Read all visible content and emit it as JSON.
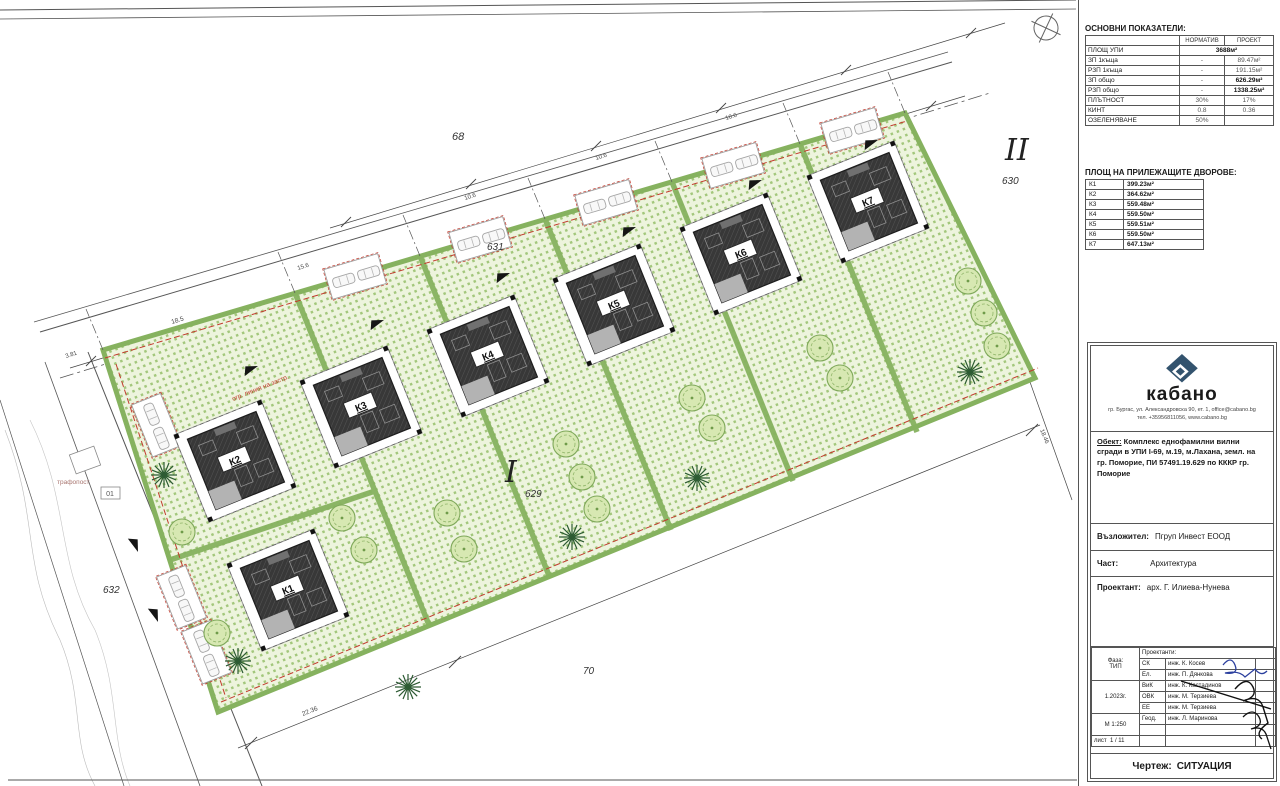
{
  "indicators_table": {
    "title": "ОСНОВНИ ПОКАЗАТЕЛИ:",
    "col_headers": [
      "НОРМАТИВ",
      "ПРОЕКТ"
    ],
    "rows": [
      {
        "label": "ПЛОЩ УПИ",
        "norm": "3688м²",
        "proj": ""
      },
      {
        "label": "ЗП 1къща",
        "norm": "-",
        "proj": "89.47м²"
      },
      {
        "label": "РЗП 1къща",
        "norm": "-",
        "proj": "191.15м²"
      },
      {
        "label": "ЗП общо",
        "norm": "-",
        "proj": "626.29м²"
      },
      {
        "label": "РЗП общо",
        "norm": "-",
        "proj": "1338.25м²"
      },
      {
        "label": "ПЛЪТНОСТ",
        "norm": "30%",
        "proj": "17%"
      },
      {
        "label": "КИНТ",
        "norm": "0.8",
        "proj": "0.36"
      },
      {
        "label": "ОЗЕЛЕНЯВАНЕ",
        "norm": "50%",
        "proj": ""
      }
    ]
  },
  "yards_table": {
    "title": "ПЛОЩ НА ПРИЛЕЖАЩИТЕ ДВОРОВЕ:",
    "rows": [
      {
        "plot": "К1",
        "area": "399.23м²"
      },
      {
        "plot": "К2",
        "area": "364.62м²"
      },
      {
        "plot": "К3",
        "area": "559.48м²"
      },
      {
        "plot": "К4",
        "area": "559.50м²"
      },
      {
        "plot": "К5",
        "area": "559.51м²"
      },
      {
        "plot": "К6",
        "area": "559.50м²"
      },
      {
        "plot": "К7",
        "area": "647.13м²"
      }
    ]
  },
  "title_block": {
    "company": "кабано",
    "address_line1": "гр. Бургас, ул. Александровска 90, ет. 1, office@cabano.bg",
    "address_line2": "тел. +35956811056, www.cabano.bg",
    "object_label": "Обект:",
    "object_text": "Комплекс еднофамилни вилни сгради в УПИ I-69, м.19, м.Лахана, земл. на гр. Поморие, ПИ 57491.19.629 по КККР гр. Поморие",
    "client_label": "Възложител:",
    "client": "Пгруп Инвест ЕООД",
    "part_label": "Част:",
    "part": "Архитектура",
    "designer_label": "Проектант:",
    "designer": "арх. Г. Илиева-Нунева",
    "phase_label": "Фаза:",
    "phase": "ТИП",
    "date": "1.2023г.",
    "scale": "М 1:250",
    "sheet_label": "лист",
    "sheet_no": "1 / 11",
    "team_header": "Проектанти:",
    "team": [
      {
        "code": "СК",
        "name": "инж. К. Косев"
      },
      {
        "code": "Ел.",
        "name": "инж. П. Дянкова"
      },
      {
        "code": "ВиК",
        "name": "инж. К. Кастадинов"
      },
      {
        "code": "ОВК",
        "name": "инж. М. Терзиева"
      },
      {
        "code": "ЕЕ",
        "name": "инж. М. Терзиева"
      },
      {
        "code": "Геод.",
        "name": "инж. Л. Маринова"
      }
    ],
    "drawing_label": "Чертеж:",
    "drawing_name": "СИТУАЦИЯ"
  },
  "plan": {
    "plots": [
      "К1",
      "К2",
      "К3",
      "К4",
      "К5",
      "К6",
      "К7"
    ],
    "roads": {
      "top": "68",
      "upper_street": "631",
      "right_parcel": "630",
      "center_parcel": "629",
      "left_street": "632",
      "bottom_parcel": "70"
    },
    "zones": [
      "I",
      "II"
    ],
    "transformer": {
      "line1": "трафопост",
      "line2": "01"
    },
    "restriction_text": "огр. линия на застр.",
    "dims": [
      "3.81",
      "18.5",
      "15.6",
      "10.6",
      "10.6",
      "10.6",
      "22.36",
      "18.46"
    ]
  },
  "colors": {
    "yard_dot_green": "#a3c77c",
    "hedge_green": "#86b25f",
    "roof_dark": "#383838",
    "restriction_red": "#c23b2e",
    "logo_navy": "#33536e",
    "signature_blue": "#2b3f9e"
  }
}
